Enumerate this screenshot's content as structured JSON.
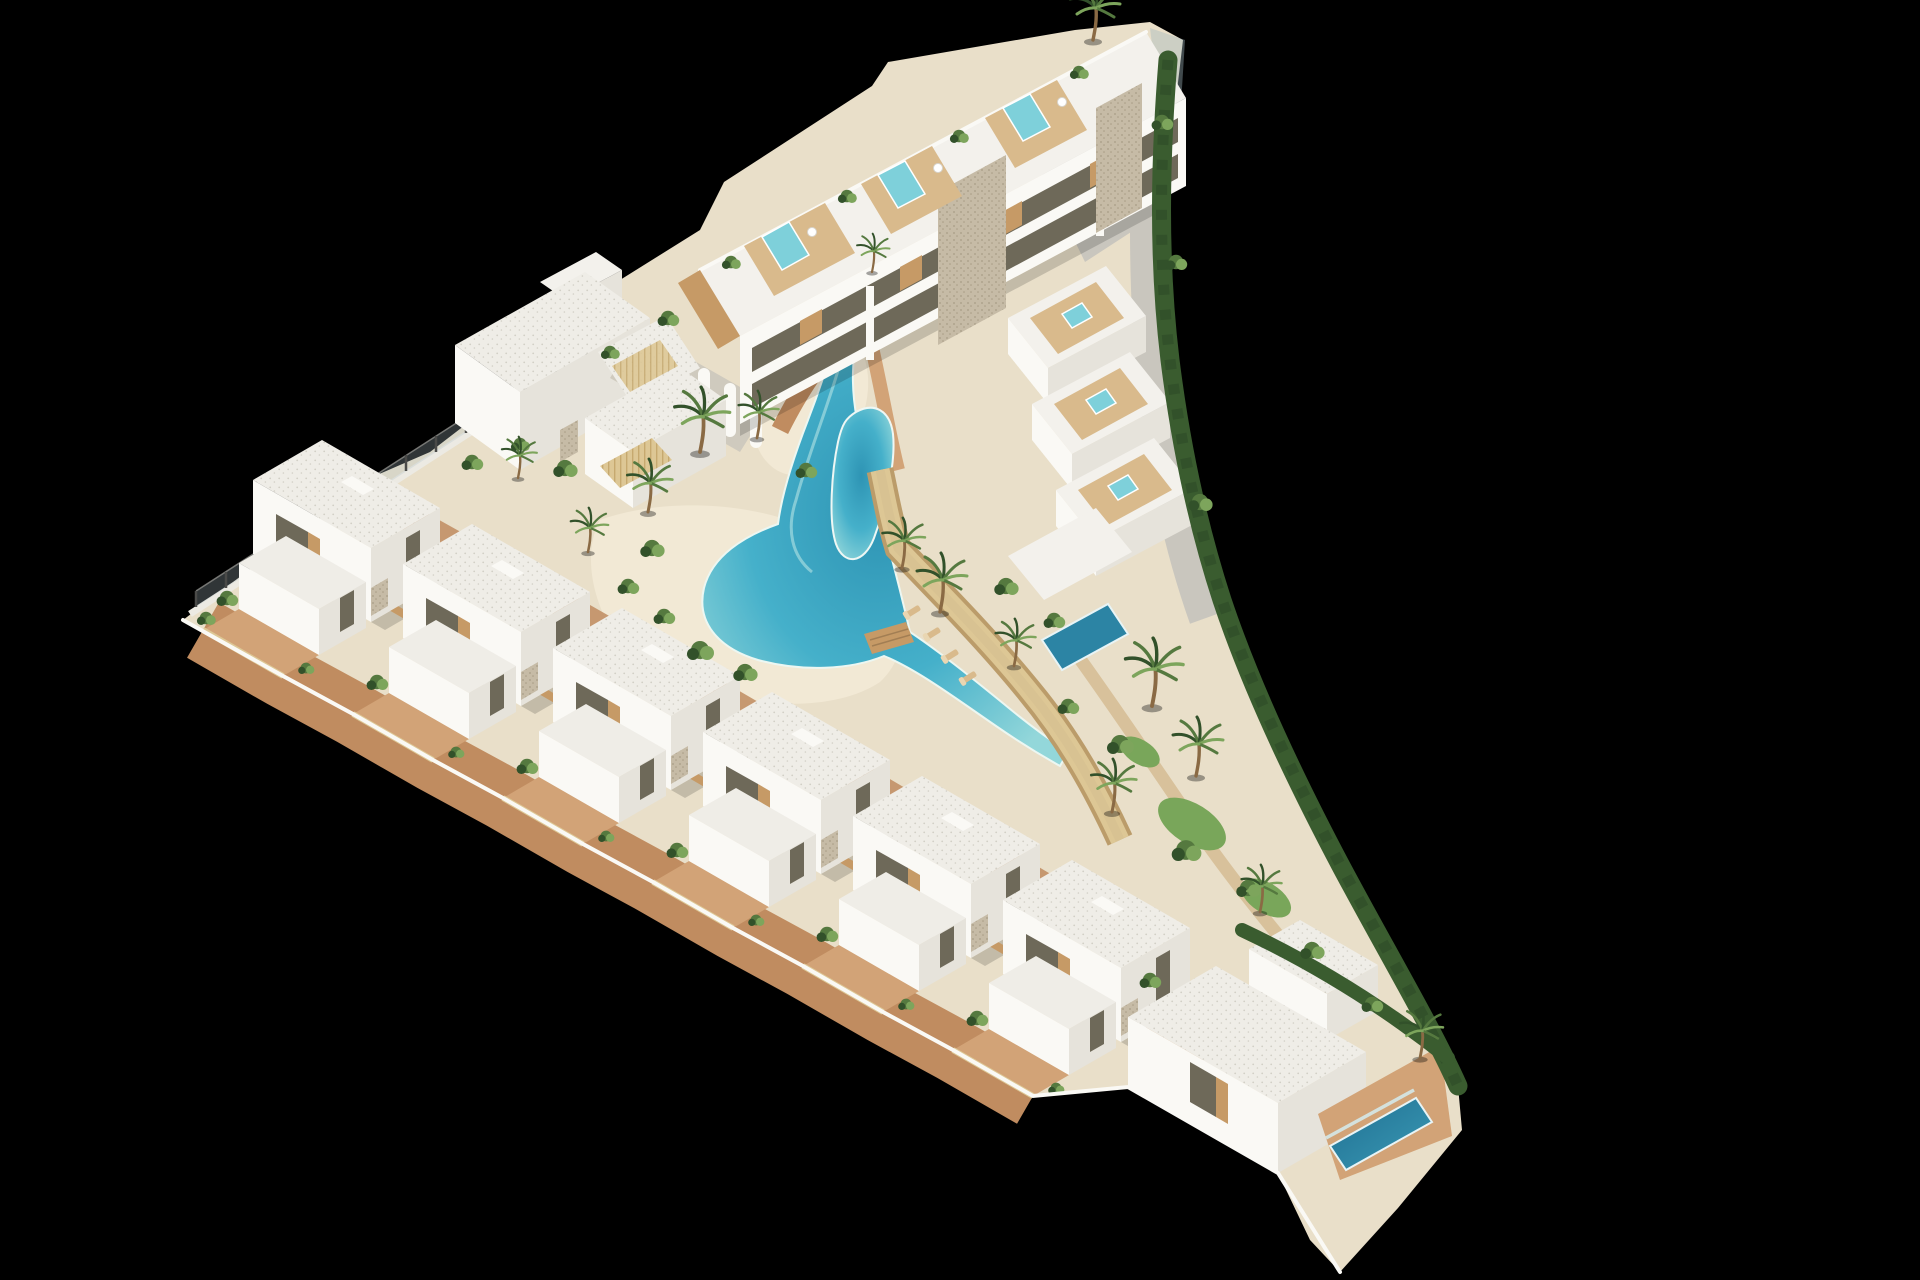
{
  "meta": {
    "type": "architectural-3d-render",
    "view": "aerial-isometric",
    "subject": "triangular coastal residential resort development on black background"
  },
  "palette": {
    "bg": "#000000",
    "wall": "#f3f1ec",
    "wallBright": "#faf9f5",
    "wallShade": "#e6e3db",
    "wallDark": "#cfcabe",
    "glass": "#6e6959",
    "roofBase": "#efede7",
    "roofDot": "#d2cfc6",
    "stone": "#c6bba6",
    "stoneDot": "#a89c85",
    "wood": "#c69a66",
    "woodLight": "#d9ba8c",
    "slat": "#ddc795",
    "terracotta": "#c08c60",
    "terracottaLight": "#d2a377",
    "sand": "#e9dfc9",
    "sandLight": "#f2e9d5",
    "poolDeep": "#2c84a4",
    "pool": "#41adc8",
    "poolLight": "#7ed0da",
    "green": "#55793f",
    "greenDark": "#32512a",
    "greenLight": "#7da55c",
    "hedge": "#3a5c2f",
    "grass": "#79a65a",
    "trunk": "#8a6a44",
    "concrete": "#c9c6be",
    "fencePost": "#4a4a48"
  },
  "scene": {
    "site_shape": "triangular wedge",
    "elements": {
      "apartment_block": "long three-storey block with rooftop wood decks and plunge pools along top edge",
      "middle_cluster": "ibiza-style villas with stepped arch fins",
      "right_cluster": "stepped terrace houses with rooftop jacuzzis",
      "villa_row": "row of detached two-storey villas with terraces and pergolas along front edge",
      "corner_compound": "large corner villas with private pool at bottom right",
      "lagoon": "winding turquoise lagoon pool with sandy beach and wooden bridge",
      "kidney_pool": "elongated kidney pool beside right cluster",
      "boundary": "curved hedge and grey access road on right, glass fence on left tip"
    },
    "counts": {
      "row_villas": 6,
      "rooftop_plunge_pools": 3,
      "rooftop_jacuzzis": 3,
      "palm_trees": 15,
      "sun_loungers": 4
    }
  }
}
